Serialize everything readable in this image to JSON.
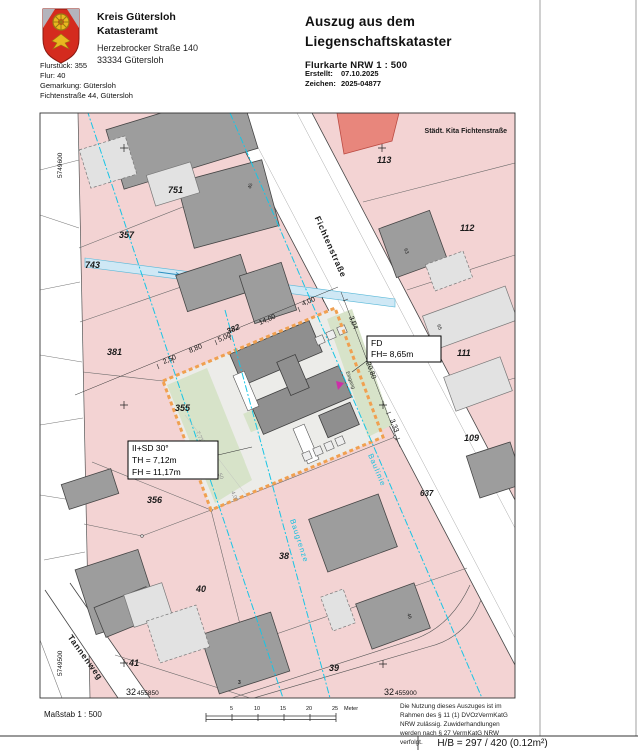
{
  "header": {
    "office_line1": "Kreis Gütersloh",
    "office_line2": "Katasteramt",
    "address_line1": "Herzebrocker Straße 140",
    "address_line2": "33334 Gütersloh",
    "title_line1": "Auszug aus dem",
    "title_line2": "Liegenschaftskataster",
    "subtitle": "Flurkarte NRW 1 : 500",
    "created_label": "Erstellt:",
    "created_value": "07.10.2025",
    "ref_label": "Zeichen:",
    "ref_value": "2025-04877"
  },
  "parcel_info": {
    "line1": "Flurstück: 355",
    "line2": "Flur: 40",
    "line3": "Gemarkung: Gütersloh",
    "line4": "Fichtenstraße 44, Gütersloh"
  },
  "map": {
    "parcel_labels": [
      "751",
      "357",
      "743",
      "381",
      "355",
      "382",
      "356",
      "38",
      "40",
      "41",
      "39",
      "113",
      "112",
      "111",
      "109",
      "637"
    ],
    "street_names": [
      "Fichtenstraße",
      "Tannenweg"
    ],
    "poi_label": "Städt. Kita Fichtenstraße",
    "house_numbers": [
      "45",
      "63",
      "65",
      "46",
      "3"
    ],
    "dimensions": [
      "2,50",
      "8,80",
      "5,00",
      "14,00",
      "4,00",
      "3,04",
      "20,80",
      "3,33"
    ],
    "site_dimensions": [
      "7,71",
      "5,00",
      "50",
      "4,00"
    ],
    "planning_labels": {
      "baugrenze": "Baugrenze",
      "baulinie": "Baulinie",
      "eingang": "Eingang"
    },
    "annotation_box_1": {
      "line1": "II+SD 30°",
      "line2": "TH = 7,12m",
      "line3": "FH = 11,17m"
    },
    "annotation_box_2": {
      "line1": "FD",
      "line2": "FH= 8,65m"
    },
    "grid_coords": {
      "north_top": "5749600",
      "north_bottom": "5749500",
      "east_left_big": "32",
      "east_left_small": "455850",
      "east_right_big": "32",
      "east_right_small": "455900"
    }
  },
  "footer": {
    "scale_label": "Maßstab 1 : 500",
    "scalebar_ticks": [
      "5",
      "10",
      "15",
      "20",
      "25"
    ],
    "scalebar_unit": "Meter",
    "legal_lines": [
      "Die Nutzung dieses Auszuges ist im",
      "Rahmen des § 11 (1) DVOzVermKatG",
      "NRW zulässig. Zuwiderhandlungen",
      "werden nach § 27 VermKatG NRW",
      "verfolgt."
    ],
    "format_note": "H/B = 297 / 420 (0.12m²)"
  },
  "colors": {
    "parcel_pink": "#f3d3d3",
    "building_gray": "#9d9d9d",
    "building_light": "#e2e2e2",
    "public_building_red": "#e8867c",
    "water_blue": "#cfe8f5",
    "construction_boundary_orange": "#f0a050",
    "planning_line_cyan": "#18c5e5",
    "entrance_magenta": "#cc2fa8",
    "site_green": "#d7e3c9"
  }
}
